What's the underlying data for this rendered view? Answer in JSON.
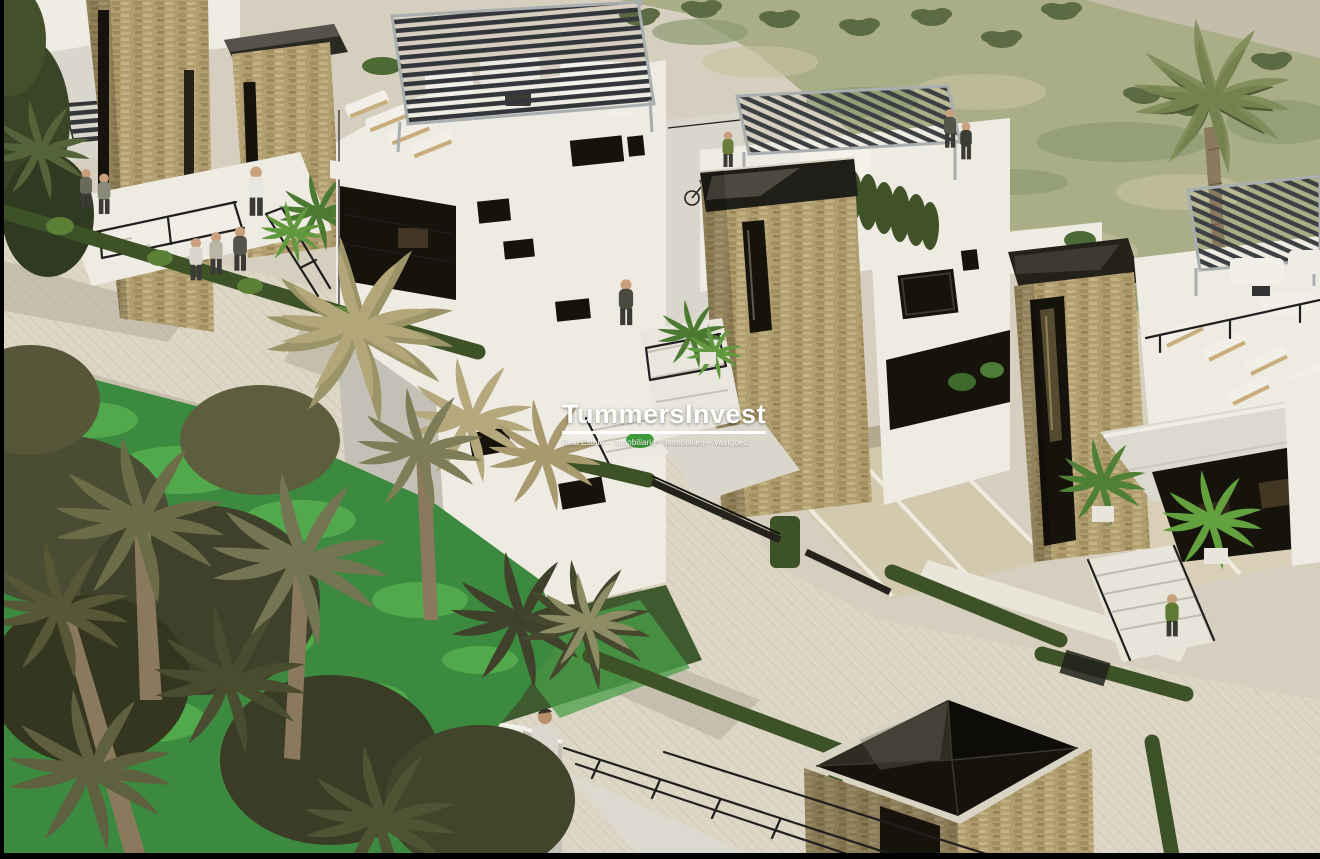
{
  "watermark": {
    "title": "TummersInvest",
    "subtitle": "Real Estate – Inmobiliaria – Immobilien – Vastgoed"
  },
  "scene": {
    "type": "architectural-render",
    "description": "Aerial 3D render of a modern villa development: white villas with stone towers, rooftop pergolas and terraces, hedged paths, palm trees and a scrubland field",
    "colors": {
      "paving": "#d6cfbf",
      "paving_light": "#ded7c6",
      "paving_shadow": "#b4ac9a",
      "wall_light": "#edebe2",
      "wall_mid": "#d9d6cb",
      "wall_shade": "#c3c0b5",
      "stone": "#b2a072",
      "stone_light": "#c6b588",
      "stone_dark": "#8e7b53",
      "glass": "#16130d",
      "pergola_slat": "#36393b",
      "pergola_frame": "#a9aeae",
      "hedge": "#3e5227",
      "hedge_light": "#5c8036",
      "grass": "#3c8a40",
      "grass_light": "#55ad4e",
      "field": "#a9ae87",
      "field_light": "#c7c2a0",
      "field_dark": "#8d9a72",
      "palm_dark": "#45472e",
      "palm_mid": "#6b6d48",
      "palm_light": "#8e8c64",
      "palm_dry": "#b3a679",
      "trunk": "#8a795c",
      "skin": "#c9a07c",
      "ink": "#1f1f1f",
      "frame": "#000000"
    }
  }
}
